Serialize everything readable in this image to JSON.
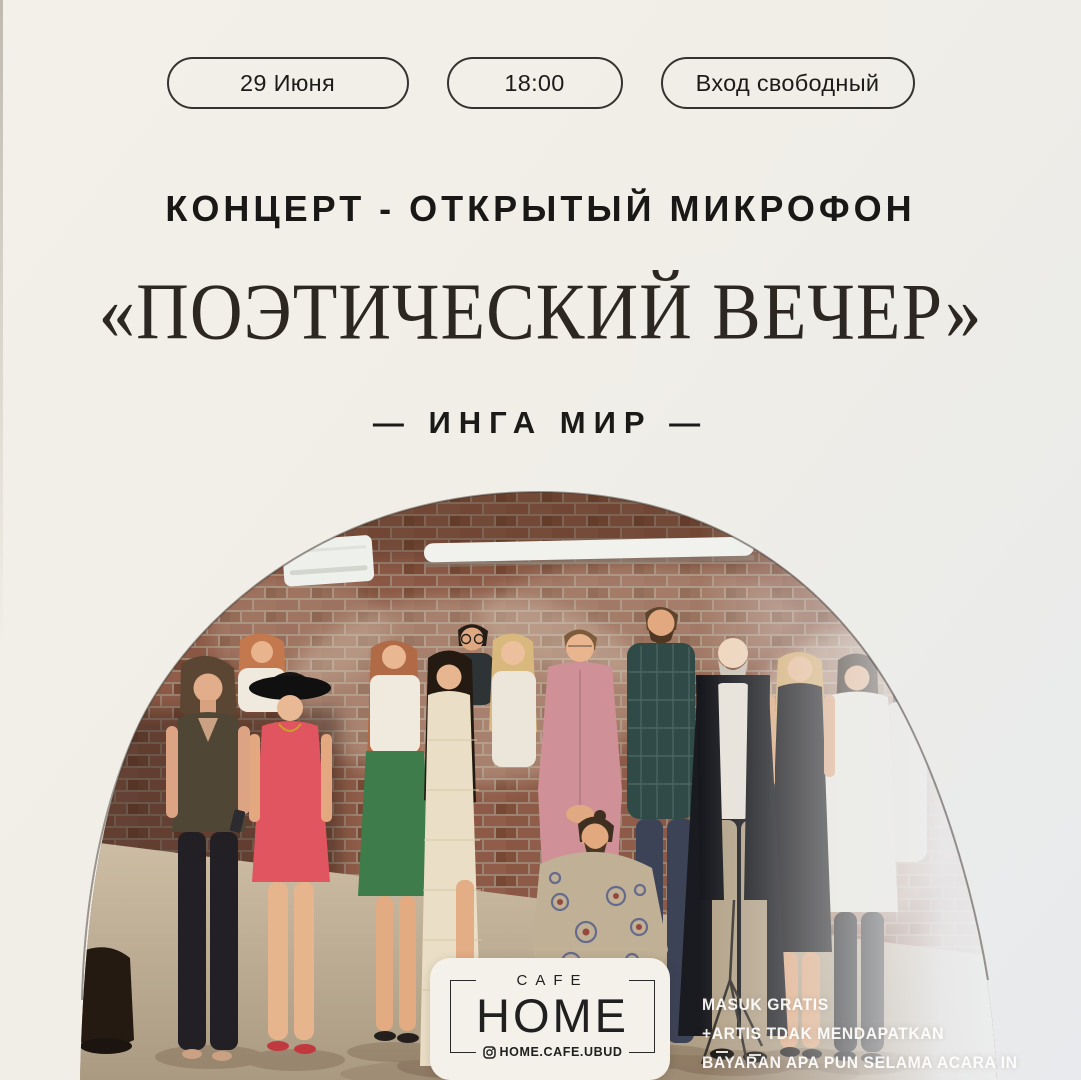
{
  "poster": {
    "badges": [
      {
        "label": "29 Июня"
      },
      {
        "label": "18:00"
      },
      {
        "label": "Вход свободный"
      }
    ],
    "kicker": "КОНЦЕРТ - ОТКРЫТЫЙ МИКРОФОН",
    "title": "«ПОЭТИЧЕСКИЙ ВЕЧЕР»",
    "artist": "— ИНГА МИР —",
    "note_lines": [
      "MASUK GRATIS",
      "+ARTIS TDAK MENDAPATKAN",
      "BAYARAN APA PUN SELAMA ACARA IN"
    ],
    "logo": {
      "top": "CAFE",
      "name": "HOME",
      "handle": "HOME.CAFE.UBUD"
    },
    "colors": {
      "background_warm": "#f2efe8",
      "background_cool": "#e8eaed",
      "ink": "#1c1b19",
      "title_ink": "#2d2722",
      "badge_outline": "#35332f",
      "note_text": "#ffffff",
      "brick": "#8a5744",
      "card": "#f4f1ea"
    }
  }
}
